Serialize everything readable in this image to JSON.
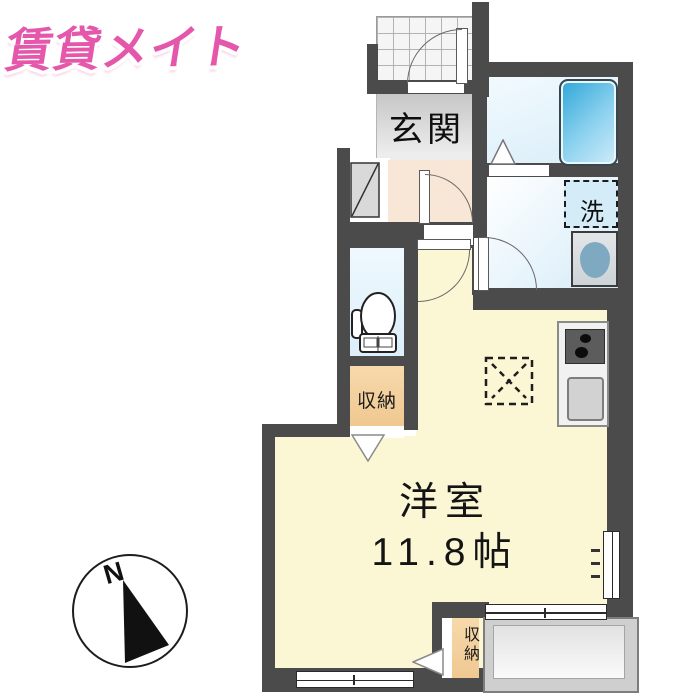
{
  "logo": {
    "text": "賃貸メイト"
  },
  "plan": {
    "entrance_label": "玄関",
    "laundry_label": "洗",
    "storage_upper_label": "収納",
    "storage_lower_label": "収納",
    "room_name": "洋室",
    "room_size": "11.8帖",
    "compass_north": "N"
  },
  "colors": {
    "wall": "#4b4b4b",
    "logo_pink": "#e457ab",
    "room_cream": "#fbf7d5",
    "hall_peach": "#f8e7d7",
    "wet_area_blue": "#d9edf9",
    "bathtub_blue": "#2fa6d8",
    "storage_orange": "#f3d1a1",
    "entrance_gray": "#d9d9d9"
  }
}
